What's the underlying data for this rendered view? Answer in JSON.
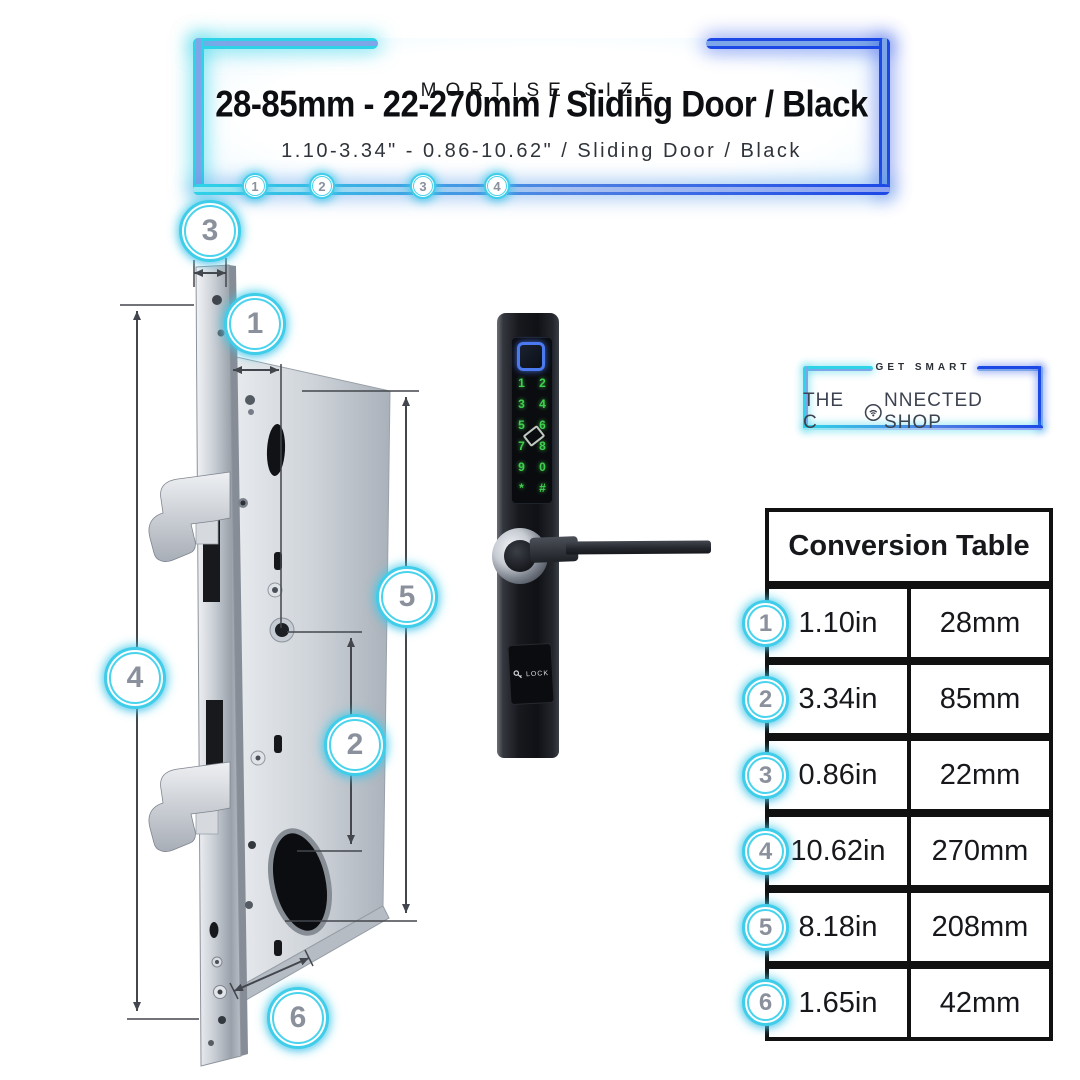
{
  "banner": {
    "header": "MORTISE SIZE",
    "title": "28-85mm - 22-270mm / Sliding Door / Black",
    "subtitle": "1.10-3.34\" - 0.86-10.62\" / Sliding Door / Black",
    "markers": [
      "1",
      "2",
      "3",
      "4"
    ]
  },
  "diagram": {
    "callouts": [
      "3",
      "1",
      "5",
      "4",
      "2",
      "6"
    ]
  },
  "device": {
    "keypad": [
      [
        "1",
        "2"
      ],
      [
        "3",
        "4"
      ],
      [
        "5",
        "6"
      ],
      [
        "7",
        "8"
      ],
      [
        "9",
        "0"
      ],
      [
        "*",
        "#"
      ]
    ],
    "lock_label": "LOCK"
  },
  "brand": {
    "tagline": "GET SMART",
    "name_pre": "THE C",
    "name_post": "NNECTED SHOP"
  },
  "table": {
    "title": "Conversion Table",
    "rows": [
      {
        "marker": "1",
        "inches": "1.10in",
        "mm": "28mm"
      },
      {
        "marker": "2",
        "inches": "3.34in",
        "mm": "85mm"
      },
      {
        "marker": "3",
        "inches": "0.86in",
        "mm": "22mm"
      },
      {
        "marker": "4",
        "inches": "10.62in",
        "mm": "270mm"
      },
      {
        "marker": "5",
        "inches": "8.18in",
        "mm": "208mm"
      },
      {
        "marker": "6",
        "inches": "1.65in",
        "mm": "42mm"
      }
    ]
  },
  "icons": {
    "wifi_o": "wifi-circle-icon",
    "fingerprint": "fingerprint-sensor-icon",
    "rfid": "rfid-card-icon",
    "key": "key-icon"
  },
  "colors": {
    "neon_cyan": "#2ed3e7",
    "neon_blue": "#1c48e6",
    "tube_core": "#7da6e8",
    "badge_ring": "#3fcde9",
    "badge_number": "#8b919c",
    "keypad_green": "#3ed24e",
    "fingerprint_blue": "#4a79f0",
    "table_border": "#111111",
    "title_text": "#0c0e12"
  }
}
